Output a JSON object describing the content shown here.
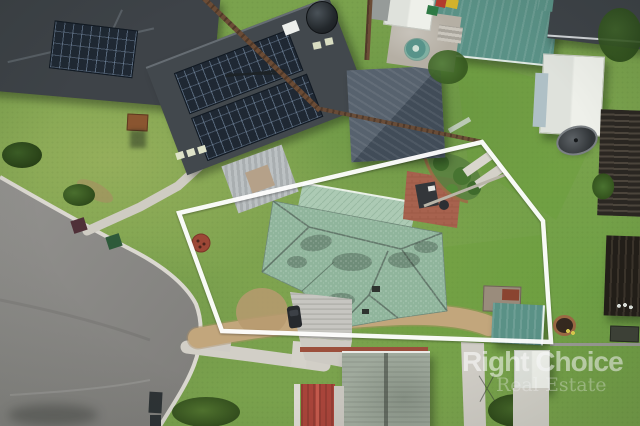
{
  "meta": {
    "type": "aerial-photograph",
    "width": 640,
    "height": 426
  },
  "watermark": {
    "line1": "Right Choice",
    "line2": "Real Estate"
  },
  "overlay": {
    "boundary_color": "#ffffff",
    "boundary_width": 4.5,
    "boundary_points": "179,213 482,142 543,221 551,342 222,331"
  },
  "palette": {
    "grass": "#7aa24d",
    "grass-bright": "#6fa23f",
    "road": "#8f8e8b",
    "curb": "#dbd8d1",
    "subject-roof": "#90b59c",
    "garage-roof": "#accab4",
    "dark-roof": "#3e4348",
    "solar": "#1f2833",
    "teal-roof": "#5a9186",
    "white-shed": "#e9ebe6",
    "gravel": "#c2a67c",
    "concrete": "#d2cfc7",
    "paver": "#a7624e",
    "fence-brown": "#6b4c36",
    "sage-roof": "#a0aa9d",
    "red-roof": "#a8443a"
  },
  "scene": {
    "description": "Aerial drone photo of a suburban cul-de-sac; the subject property with a weathered green hip roof is outlined by a white boundary line; neighbouring houses have dark tiled roofs with solar panels; a grey cul-de-sac road curves at lower left; sheds, lawns and backyards surround.",
    "objects": [
      "cul-de-sac road",
      "subject house green roof",
      "white boundary outline",
      "solar panel house",
      "dark roof house",
      "metal garage",
      "teal shed",
      "white shed",
      "satellite dish",
      "water tank",
      "wheelie bins",
      "picnic table",
      "gravel driveway",
      "red garden bed",
      "paver patio",
      "sage roof house",
      "red tile roof",
      "street trees",
      "watermark"
    ]
  }
}
